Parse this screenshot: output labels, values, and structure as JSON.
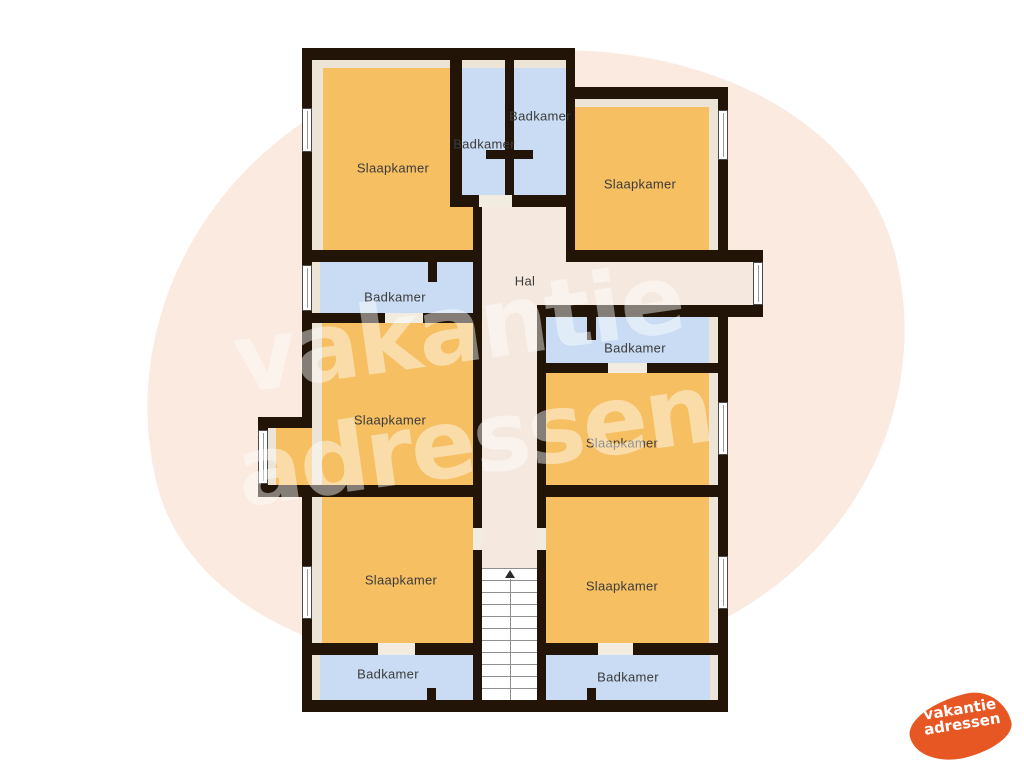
{
  "page": {
    "background": "#ffffff",
    "type": "floor-plan-image"
  },
  "watermark": {
    "line1": "vakantie",
    "line2": "adressen",
    "text_color": "#ffffff",
    "blob_color": "#fbeadf"
  },
  "logo": {
    "line1": "vakantie",
    "line2": "adressen",
    "bg_color": "#e65723",
    "text_color": "#ffffff"
  },
  "colors": {
    "wall": "#221508",
    "bedroom": "#f6bf62",
    "bathroom": "#c9dcf4",
    "hall": "#f5e8de",
    "strip": "#ece4d6",
    "threshold": "#f2ebe0",
    "window": "#ffffff",
    "stairs_line": "#8f8f8f",
    "label": "#3b3b3b"
  },
  "floorplan": {
    "elements": [
      {
        "n": "room-slaapkamer-top-left",
        "c": "bedroom",
        "x": 312,
        "y": 60,
        "w": 161,
        "h": 190
      },
      {
        "n": "room-badkamer-stall-left",
        "c": "bathroom",
        "x": 462,
        "y": 60,
        "w": 43,
        "h": 135
      },
      {
        "n": "room-badkamer-stall-right",
        "c": "bathroom",
        "x": 514,
        "y": 60,
        "w": 52,
        "h": 135
      },
      {
        "n": "room-slaapkamer-top-right",
        "c": "bedroom",
        "x": 575,
        "y": 99,
        "w": 143,
        "h": 151
      },
      {
        "n": "hall-lobby",
        "c": "hall",
        "x": 482,
        "y": 203,
        "w": 84,
        "h": 59
      },
      {
        "n": "hall-arm",
        "c": "hall",
        "x": 482,
        "y": 262,
        "w": 273,
        "h": 43
      },
      {
        "n": "hall-corridor",
        "c": "hall",
        "x": 482,
        "y": 305,
        "w": 55,
        "h": 395
      },
      {
        "n": "room-badkamer-mid-left",
        "c": "bathroom",
        "x": 312,
        "y": 262,
        "w": 161,
        "h": 51
      },
      {
        "n": "room-badkamer-mid-right",
        "c": "bathroom",
        "x": 546,
        "y": 317,
        "w": 172,
        "h": 46
      },
      {
        "n": "room-slaapkamer-mid-left",
        "c": "bedroom",
        "x": 312,
        "y": 323,
        "w": 161,
        "h": 162
      },
      {
        "n": "alcove-slaapkamer-mid-left",
        "c": "bedroom",
        "x": 268,
        "y": 428,
        "w": 44,
        "h": 57
      },
      {
        "n": "room-slaapkamer-mid-right",
        "c": "bedroom",
        "x": 546,
        "y": 373,
        "w": 172,
        "h": 112
      },
      {
        "n": "room-slaapkamer-bottom-left",
        "c": "bedroom",
        "x": 312,
        "y": 497,
        "w": 161,
        "h": 146
      },
      {
        "n": "room-slaapkamer-bottom-right",
        "c": "bedroom",
        "x": 546,
        "y": 497,
        "w": 172,
        "h": 146
      },
      {
        "n": "room-badkamer-bottom-left",
        "c": "bathroom",
        "x": 312,
        "y": 655,
        "w": 161,
        "h": 45
      },
      {
        "n": "room-badkamer-bottom-right",
        "c": "bathroom",
        "x": 546,
        "y": 655,
        "w": 172,
        "h": 45
      },
      {
        "n": "edge-strip",
        "c": "strip",
        "x": 312,
        "y": 60,
        "w": 11,
        "h": 190
      },
      {
        "n": "edge-strip",
        "c": "strip",
        "x": 312,
        "y": 60,
        "w": 161,
        "h": 8
      },
      {
        "n": "edge-strip",
        "c": "strip",
        "x": 462,
        "y": 60,
        "w": 104,
        "h": 8
      },
      {
        "n": "edge-strip",
        "c": "strip",
        "x": 575,
        "y": 99,
        "w": 143,
        "h": 8
      },
      {
        "n": "edge-strip",
        "c": "strip",
        "x": 709,
        "y": 99,
        "w": 9,
        "h": 151
      },
      {
        "n": "edge-strip",
        "c": "strip",
        "x": 312,
        "y": 262,
        "w": 8,
        "h": 51
      },
      {
        "n": "edge-strip",
        "c": "strip",
        "x": 312,
        "y": 323,
        "w": 10,
        "h": 162
      },
      {
        "n": "edge-strip",
        "c": "strip",
        "x": 268,
        "y": 428,
        "w": 8,
        "h": 57
      },
      {
        "n": "edge-strip",
        "c": "strip",
        "x": 709,
        "y": 317,
        "w": 9,
        "h": 46
      },
      {
        "n": "edge-strip",
        "c": "strip",
        "x": 709,
        "y": 373,
        "w": 9,
        "h": 112
      },
      {
        "n": "edge-strip",
        "c": "strip",
        "x": 312,
        "y": 497,
        "w": 10,
        "h": 146
      },
      {
        "n": "edge-strip",
        "c": "strip",
        "x": 709,
        "y": 497,
        "w": 9,
        "h": 146
      },
      {
        "n": "edge-strip",
        "c": "strip",
        "x": 312,
        "y": 655,
        "w": 8,
        "h": 45
      },
      {
        "n": "edge-strip",
        "c": "strip",
        "x": 710,
        "y": 655,
        "w": 8,
        "h": 45
      },
      {
        "n": "wall",
        "c": "wall",
        "x": 302,
        "y": 48,
        "w": 273,
        "h": 12
      },
      {
        "n": "wall",
        "c": "wall",
        "x": 302,
        "y": 48,
        "w": 10,
        "h": 369
      },
      {
        "n": "wall",
        "c": "wall",
        "x": 258,
        "y": 417,
        "w": 54,
        "h": 11
      },
      {
        "n": "wall",
        "c": "wall",
        "x": 258,
        "y": 417,
        "w": 10,
        "h": 80
      },
      {
        "n": "wall",
        "c": "wall",
        "x": 258,
        "y": 485,
        "w": 219,
        "h": 12
      },
      {
        "n": "wall",
        "c": "wall",
        "x": 302,
        "y": 497,
        "w": 10,
        "h": 215
      },
      {
        "n": "wall",
        "c": "wall",
        "x": 302,
        "y": 700,
        "w": 426,
        "h": 12
      },
      {
        "n": "wall",
        "c": "wall",
        "x": 718,
        "y": 317,
        "w": 10,
        "h": 395
      },
      {
        "n": "wall",
        "c": "wall",
        "x": 566,
        "y": 87,
        "w": 162,
        "h": 12
      },
      {
        "n": "wall",
        "c": "wall",
        "x": 718,
        "y": 87,
        "w": 10,
        "h": 163
      },
      {
        "n": "wall",
        "c": "wall",
        "x": 450,
        "y": 48,
        "w": 12,
        "h": 159
      },
      {
        "n": "wall",
        "c": "wall",
        "x": 505,
        "y": 48,
        "w": 9,
        "h": 147
      },
      {
        "n": "wall",
        "c": "wall",
        "x": 486,
        "y": 150,
        "w": 47,
        "h": 9
      },
      {
        "n": "wall",
        "c": "wall",
        "x": 450,
        "y": 195,
        "w": 125,
        "h": 12
      },
      {
        "n": "wall",
        "c": "wall",
        "x": 302,
        "y": 250,
        "w": 180,
        "h": 12
      },
      {
        "n": "wall",
        "c": "wall",
        "x": 428,
        "y": 262,
        "w": 9,
        "h": 20
      },
      {
        "n": "wall",
        "c": "wall",
        "x": 302,
        "y": 313,
        "w": 171,
        "h": 10
      },
      {
        "n": "wall",
        "c": "wall",
        "x": 473,
        "y": 195,
        "w": 9,
        "h": 517
      },
      {
        "n": "wall",
        "c": "wall",
        "x": 566,
        "y": 48,
        "w": 9,
        "h": 214
      },
      {
        "n": "wall",
        "c": "wall",
        "x": 566,
        "y": 250,
        "w": 197,
        "h": 12
      },
      {
        "n": "wall",
        "c": "wall",
        "x": 753,
        "y": 250,
        "w": 10,
        "h": 67
      },
      {
        "n": "wall",
        "c": "wall",
        "x": 537,
        "y": 305,
        "w": 226,
        "h": 12
      },
      {
        "n": "wall",
        "c": "wall",
        "x": 537,
        "y": 305,
        "w": 9,
        "h": 407
      },
      {
        "n": "wall",
        "c": "wall",
        "x": 587,
        "y": 317,
        "w": 9,
        "h": 23
      },
      {
        "n": "wall",
        "c": "wall",
        "x": 537,
        "y": 363,
        "w": 191,
        "h": 10
      },
      {
        "n": "wall",
        "c": "wall",
        "x": 537,
        "y": 485,
        "w": 191,
        "h": 12
      },
      {
        "n": "wall",
        "c": "wall",
        "x": 302,
        "y": 643,
        "w": 180,
        "h": 12
      },
      {
        "n": "wall",
        "c": "wall",
        "x": 537,
        "y": 643,
        "w": 191,
        "h": 12
      },
      {
        "n": "wall",
        "c": "wall",
        "x": 427,
        "y": 688,
        "w": 9,
        "h": 14
      },
      {
        "n": "wall",
        "c": "wall",
        "x": 587,
        "y": 688,
        "w": 9,
        "h": 14
      },
      {
        "n": "door-opening",
        "c": "threshold",
        "x": 479,
        "y": 195,
        "w": 33,
        "h": 12
      },
      {
        "n": "door-opening",
        "c": "threshold",
        "x": 385,
        "y": 313,
        "w": 38,
        "h": 10
      },
      {
        "n": "door-opening",
        "c": "threshold",
        "x": 608,
        "y": 363,
        "w": 39,
        "h": 10
      },
      {
        "n": "door-opening",
        "c": "threshold",
        "x": 378,
        "y": 643,
        "w": 37,
        "h": 12
      },
      {
        "n": "door-opening",
        "c": "threshold",
        "x": 598,
        "y": 643,
        "w": 35,
        "h": 12
      },
      {
        "n": "door-opening",
        "c": "threshold",
        "x": 537,
        "y": 528,
        "w": 9,
        "h": 22
      },
      {
        "n": "door-opening",
        "c": "threshold",
        "x": 473,
        "y": 528,
        "w": 9,
        "h": 22
      }
    ],
    "windows": [
      {
        "x": 302,
        "y": 108,
        "w": 10,
        "h": 44
      },
      {
        "x": 302,
        "y": 265,
        "w": 10,
        "h": 46
      },
      {
        "x": 718,
        "y": 110,
        "w": 10,
        "h": 50
      },
      {
        "x": 258,
        "y": 430,
        "w": 10,
        "h": 54
      },
      {
        "x": 718,
        "y": 402,
        "w": 10,
        "h": 53
      },
      {
        "x": 302,
        "y": 566,
        "w": 10,
        "h": 53
      },
      {
        "x": 718,
        "y": 556,
        "w": 10,
        "h": 53
      },
      {
        "x": 753,
        "y": 262,
        "w": 10,
        "h": 43
      }
    ],
    "stairs": {
      "x": 482,
      "y": 568,
      "w": 55,
      "h": 132
    },
    "labels": [
      {
        "x": 393,
        "y": 168,
        "text": "Slaapkamer"
      },
      {
        "x": 484,
        "y": 144,
        "text": "Badkamer"
      },
      {
        "x": 540,
        "y": 116,
        "text": "Badkamer"
      },
      {
        "x": 640,
        "y": 184,
        "text": "Slaapkamer"
      },
      {
        "x": 395,
        "y": 297,
        "text": "Badkamer"
      },
      {
        "x": 525,
        "y": 281,
        "text": "Hal"
      },
      {
        "x": 635,
        "y": 348,
        "text": "Badkamer"
      },
      {
        "x": 390,
        "y": 420,
        "text": "Slaapkamer"
      },
      {
        "x": 622,
        "y": 443,
        "text": "Slaapkamer"
      },
      {
        "x": 401,
        "y": 580,
        "text": "Slaapkamer"
      },
      {
        "x": 622,
        "y": 586,
        "text": "Slaapkamer"
      },
      {
        "x": 388,
        "y": 674,
        "text": "Badkamer"
      },
      {
        "x": 628,
        "y": 677,
        "text": "Badkamer"
      }
    ]
  }
}
